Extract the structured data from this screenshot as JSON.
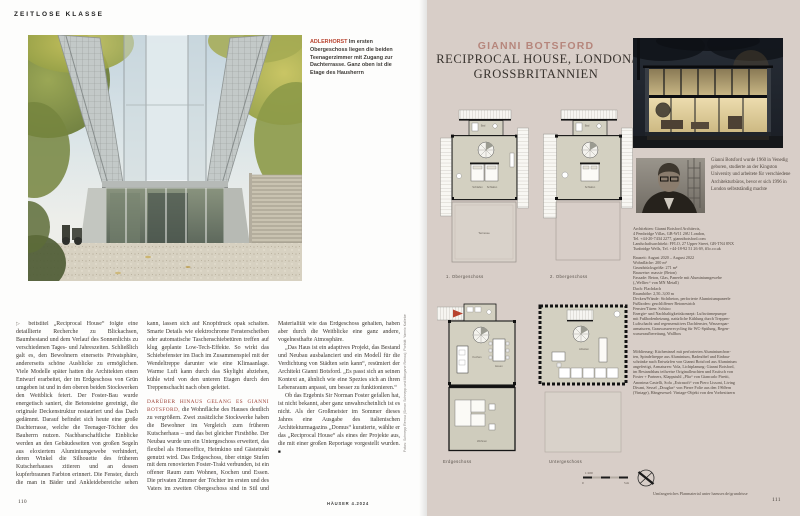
{
  "magazine": {
    "left_page": {
      "kicker": "ZEITLOSE KLASSE",
      "photo_caption": {
        "lead": "ADLERHORST",
        "text": " Im ersten Obergeschoss liegen die beiden Teenagerzimmer mit Zugang zur Dachterrasse. Ganz oben ist die Etage des Hausherrn"
      },
      "article": {
        "continuation_mark": "▷",
        "p1": "beitstitel „Reciprocal House“ folgte eine detaillierte Recherche zu Blickachsen, Baumbestand und dem Verlauf des Sonnenlichts zu verschiedenen Tages- und Jahreszeiten. Schließlich galt es, den Bewohnern einerseits Privatsphäre, andererseits schöne Ausblicke zu ermöglichen. Viele Modelle später hatten die Architekten einen Entwurf erarbeitet, der im Erdgeschoss von Grün umgeben ist und in den oberen beiden Stockwerken den Weitblick feiert. Der Foster-Bau wurde energetisch saniert, die Betonsteine gereinigt, die originale Deckenstruktur restauriert und das Dach gedämmt. Darauf befindet sich heute eine große Dachterrasse, welche die Teenager-Töchter des Bauherrn nutzen. Nachbarschaftliche Einblicke werden an den Gebäudeseiten von großen Segeln aus eloxiertem Aluminiumgewebe verhindert, deren Winkel die Silhouette des früheren Kutscherhauses zitieren und an dessen kupferbraunen Farbton erinnert. Die Fenster, durch die man in Bäder und Ankleidebereiche sehen kann, lassen sich auf Knopfdruck opak schalten. Smarte Details wie elektrochrome Fensterscheiben oder automatische Taschenschiebetüren treffen auf klug geplante Low-Tech-Effekte. So wirkt das Schiebefenster im Dach im Zusammenspiel mit der Wendeltreppe darunter wie eine Klimaanlage. Warme Luft kann durch das Skylight abziehen, kühle wird von den unteren Etagen durch den Treppenschacht nach oben geleitet.",
        "p2_lead": "Darüber hinaus gelang es Gianni Botsford,",
        "p2_rest": " die Wohnfläche des Hauses deutlich zu vergrößern. Zwei zusätzliche Stockwerke haben die Bewohner im Vergleich zum früheren Kutscherhaus – und das bei gleicher Firsthöhe. Der Neubau wurde um ein Untergeschoss erweitert, das flexibel als Homeoffice, Heimkino und Gästetrakt genutzt wird. Das Erdgeschoss, über einige Stufen mit dem renovierten Foster-Trakt verbunden, ist ein offener Raum zum Wohnen, Kochen und Essen. Die privaten Zimmer der Töchter im ersten und des Vaters im zweiten Obergeschoss sind in Stil und Materialität wie das Erdgeschoss gehalten, haben aber durch die Weitblicke eine ganz andere, vogelnesthafte Atmosphäre.",
        "p3": "„Das Haus ist ein adaptives Projekt, das Bestand und Neubau ausbalanciert und ein Modell für die Verdichtung von Städten sein kann“, resümiert der Architekt Gianni Botsford. „Es passt sich an seinen Kontext an, ähnlich wie eine Spezies sich an ihren Lebensraum anpasst, um besser zu funktionieren.“",
        "p4": "Ob das Ergebnis Sir Norman Foster gefallen hat, ist nicht bekannt, aber ganz unwahrscheinlich ist es nicht. Als der Großmeister im Sommer dieses Jahres eine Ausgabe des italienischen Architekturmagazins „Domus“ kuratierte, wählte er das „Reciprocal House“ als eines der Projekte aus, die mit einer großen Reportage vorgestellt wurden.",
        "end_mark": "■"
      },
      "photo_credit": "Fotos: Schnepp Renou (Simon Schnepp und Morgane Renou); Porträt: Yannic Kaliebe",
      "page_number": "110",
      "footer": "HÄUSER 4.2024"
    },
    "right_page": {
      "architect_name": "GIANNI BOTSFORD",
      "project_title_line1": "RECIPROCAL HOUSE, LONDON/",
      "project_title_line2": "GROSSBRITANNIEN",
      "plans": {
        "captions": [
          "1. Obergeschoss",
          "2. Obergeschoss",
          "Erdgeschoss",
          "Untergeschoss"
        ],
        "room_labels": {
          "bad": "Bad",
          "schlafen": "Schlafen",
          "terrasse": "Terrasse",
          "kochen": "Kochen",
          "essen": "Essen",
          "wohnen": "Wohnen",
          "arbeiten": "Arbeiten"
        },
        "scale_ratio": "1:100",
        "scale_start": "0",
        "scale_end": "5 m"
      },
      "bio": "Gianni Botsford wurde 1960 in Venedig geboren, studierte an der Kingston University und arbeitete für verschiedene Architekturbüros, bevor er sich 1996 in London selbstständig machte",
      "contact": "Architekten: Gianni Botsford Architects,\n4 Pembridge Villas, GB-W11 2SU London,\nTel. +44-20-7434 2277, giannibotsford.com\nLandschaftsarchitekt: FFLO, 27 Upper Street, GB-TN4 8NX\nTunbridge Wells, Tel. +44-18-92 51 26 69, fflo.co.uk",
      "facts": "Bauzeit: August 2020 – August 2022\nWohnfläche: 200 m²\nGrundstücksgröße: 271 m²\nBauweise: massiv (Beton)\nFassade: Beton, Glas, Paneele mit Aluminiumgewebe\n(„Welltec“ von MN Metall)\nDach: Flachdach\nRaumhöhe: 2,50–3,00 m\nDecken/Wände: Sichtbeton, perforierte Aluminiumpaneele\nFußboden: geschliffener Betonestrich\nFenster/Türen: Schüco\nEnergie- und Nachhaltigkeitskonzept: Luftwärmepumpe\nmit Fußbodenheizung, natürliche Kühlung durch Treppen-\nLuftschacht und regensensitives Dachfenster, Wasserspar-\narmaturen, Grauwasserrecycling für WC-Spülung, Regen-\nwasseraufbereitung, Wallbox",
      "furnishing": "Möblierung: Kücheninsel mit perforierten Aluminiumfron-\nten, Spindeltreppe aus Aluminium, Badmöbel und Einbau-\nschränke nach Entwürfen von Gianni Botsford aus Aluminium\nangefertigt, Armaturen: Vola, Lichtplanung: Gianni Botsford,\nim Bestandsbau teilweise Originalleuchten und Esstisch von\nFoster + Partners, Klappstuhl „Plia“ von Giancarlo Piretti,\nAnonima Castelli, Sofa „Extrasoft“ von Piero Lissoni, Living\nDivani, Sessel „Douglas“ von Pierre Folie aus den 1960ern\n(Vintage), Hängesessel: Vintage-Objekt von den Vorbesitzern",
      "plan_note": "Umfangreiches Planmaterial unter haeuser.de/grundrisse",
      "page_number": "111"
    },
    "colors": {
      "accent_red": "#b8432f",
      "title_rose": "#b6867c",
      "right_page_background": "#d8cec8"
    }
  }
}
